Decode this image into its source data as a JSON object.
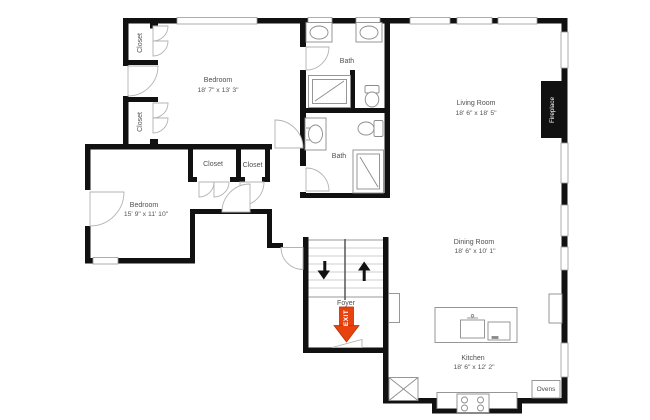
{
  "plan": {
    "type": "floor-plan",
    "rooms": {
      "bedroom1": {
        "name": "Bedroom",
        "dims": "18' 7\" x 13' 3\""
      },
      "bath1": {
        "name": "Bath"
      },
      "living": {
        "name": "Living Room",
        "dims": "18' 6\" x 18' 5\""
      },
      "bath2": {
        "name": "Bath"
      },
      "bedroom2": {
        "name": "Bedroom",
        "dims": "15' 9\" x 11' 10\""
      },
      "dining": {
        "name": "Dining Room",
        "dims": "18' 6\" x 10' 1\""
      },
      "foyer": {
        "name": "Foyer"
      },
      "kitchen": {
        "name": "Kitchen",
        "dims": "18' 6\" x 12' 2\""
      }
    },
    "labels": {
      "closet": "Closet",
      "fireplace": "Fireplace",
      "ovens": "Ovens",
      "exit": "EXIT"
    },
    "colors": {
      "wall": "#111111",
      "exit_arrow": "#e8420f",
      "label_text": "#4f4f4f"
    }
  }
}
